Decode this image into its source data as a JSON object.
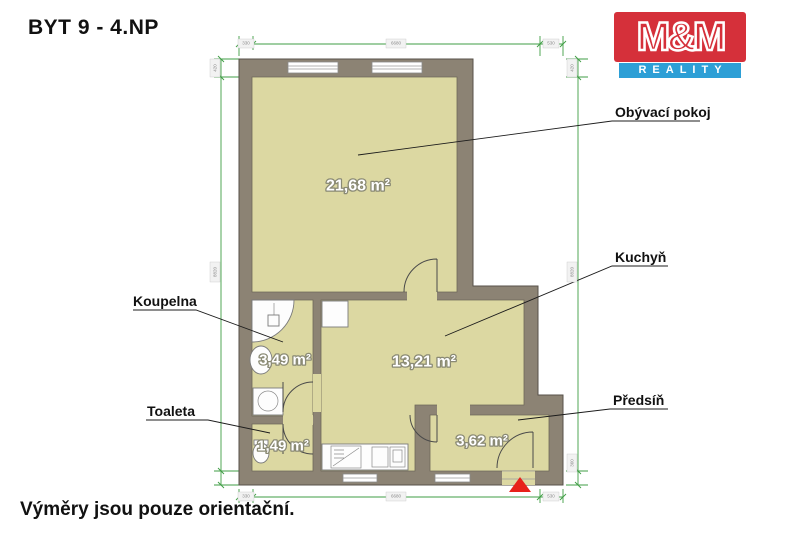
{
  "header": {
    "title": "BYT 9 - 4.NP"
  },
  "logo": {
    "line1": "M&M",
    "line2": "REALITY",
    "red": "#d5303a",
    "blue": "#2d9fd6"
  },
  "footer": {
    "note": "Výměry jsou pouze orientační."
  },
  "plan": {
    "colors": {
      "wall": "#8c8374",
      "floor": "#dcd8a2",
      "dimension_lines": "#3f9e44",
      "entrance_arrow": "#e8211a"
    },
    "rooms": [
      {
        "id": "obyvaci-pokoj",
        "label": "Obývací pokoj",
        "area": "21,68 m²"
      },
      {
        "id": "kuchyn",
        "label": "Kuchyň",
        "area": "13,21 m²"
      },
      {
        "id": "koupelna",
        "label": "Koupelna",
        "area": "3,49 m²"
      },
      {
        "id": "toaleta",
        "label": "Toaleta",
        "area": "1,49 m²"
      },
      {
        "id": "predsin",
        "label": "Předsíň",
        "area": "3,62 m²"
      }
    ],
    "dims": {
      "top": [
        {
          "t": "330"
        },
        {
          "t": "6680"
        },
        {
          "t": "530"
        }
      ],
      "bottom": [
        {
          "t": "330"
        },
        {
          "t": "6680"
        },
        {
          "t": "530"
        }
      ],
      "left": [
        {
          "t": "420"
        },
        {
          "t": "8820"
        }
      ],
      "right": [
        {
          "t": "420"
        },
        {
          "t": "8820"
        },
        {
          "t": "360"
        }
      ]
    }
  }
}
